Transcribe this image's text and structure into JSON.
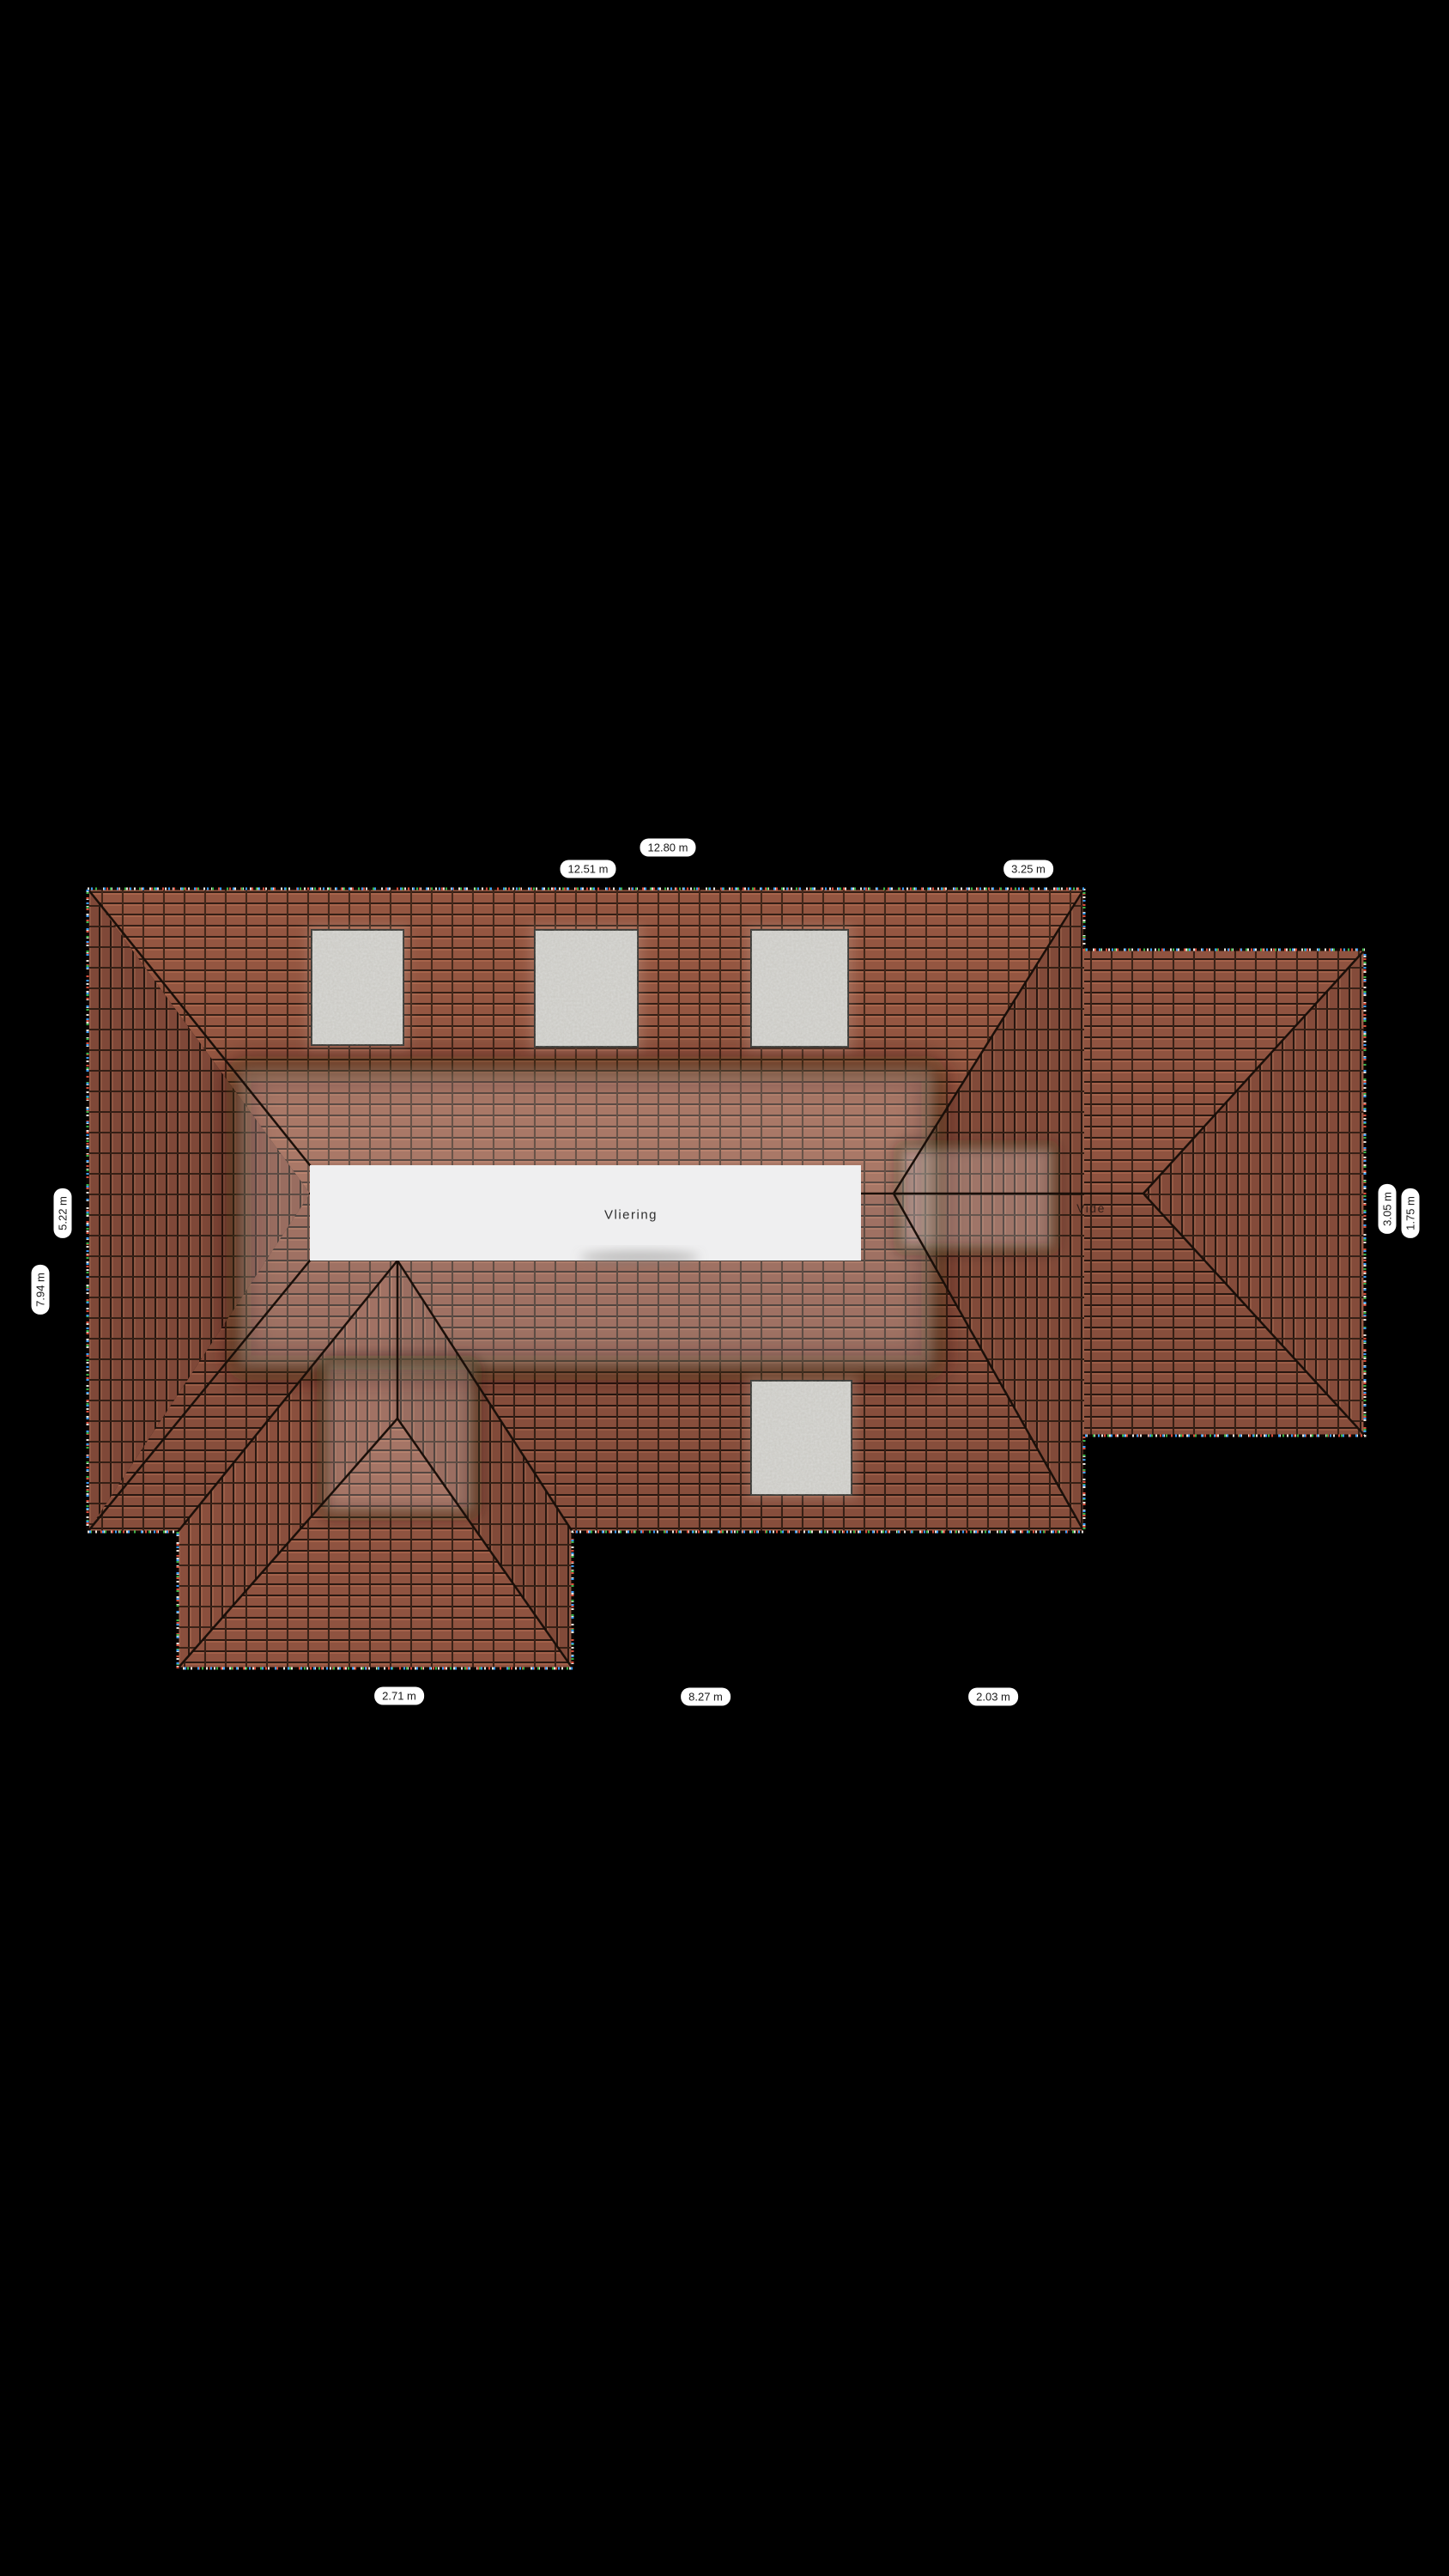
{
  "scene": {
    "type": "roof-plan",
    "background_color": "#000000",
    "floor_name": "Vliering"
  },
  "rooms": [
    {
      "label": "Vliering"
    },
    {
      "label": "Vide"
    }
  ],
  "dimensions": {
    "top": [
      "12.51 m",
      "12.80 m",
      "3.25 m"
    ],
    "bottom": [
      "2.71 m",
      "8.27 m",
      "2.03 m"
    ],
    "left": [
      "5.22 m",
      "7.94 m"
    ],
    "right": [
      "3.05 m",
      "1.75 m"
    ]
  },
  "skylights": {
    "count": 4
  },
  "colors": {
    "roof_tile": "#8f5340",
    "roof_tile_highlight": "#a3614a",
    "tile_gap": "#2a1811",
    "roof_line": "#1a0f09",
    "skylight_fill": "#d9d9d6",
    "skylight_border": "#3b3b38",
    "floor_area_fill": "#efeff0",
    "label_bg": "#ffffff",
    "label_text": "#1a1a1a"
  }
}
